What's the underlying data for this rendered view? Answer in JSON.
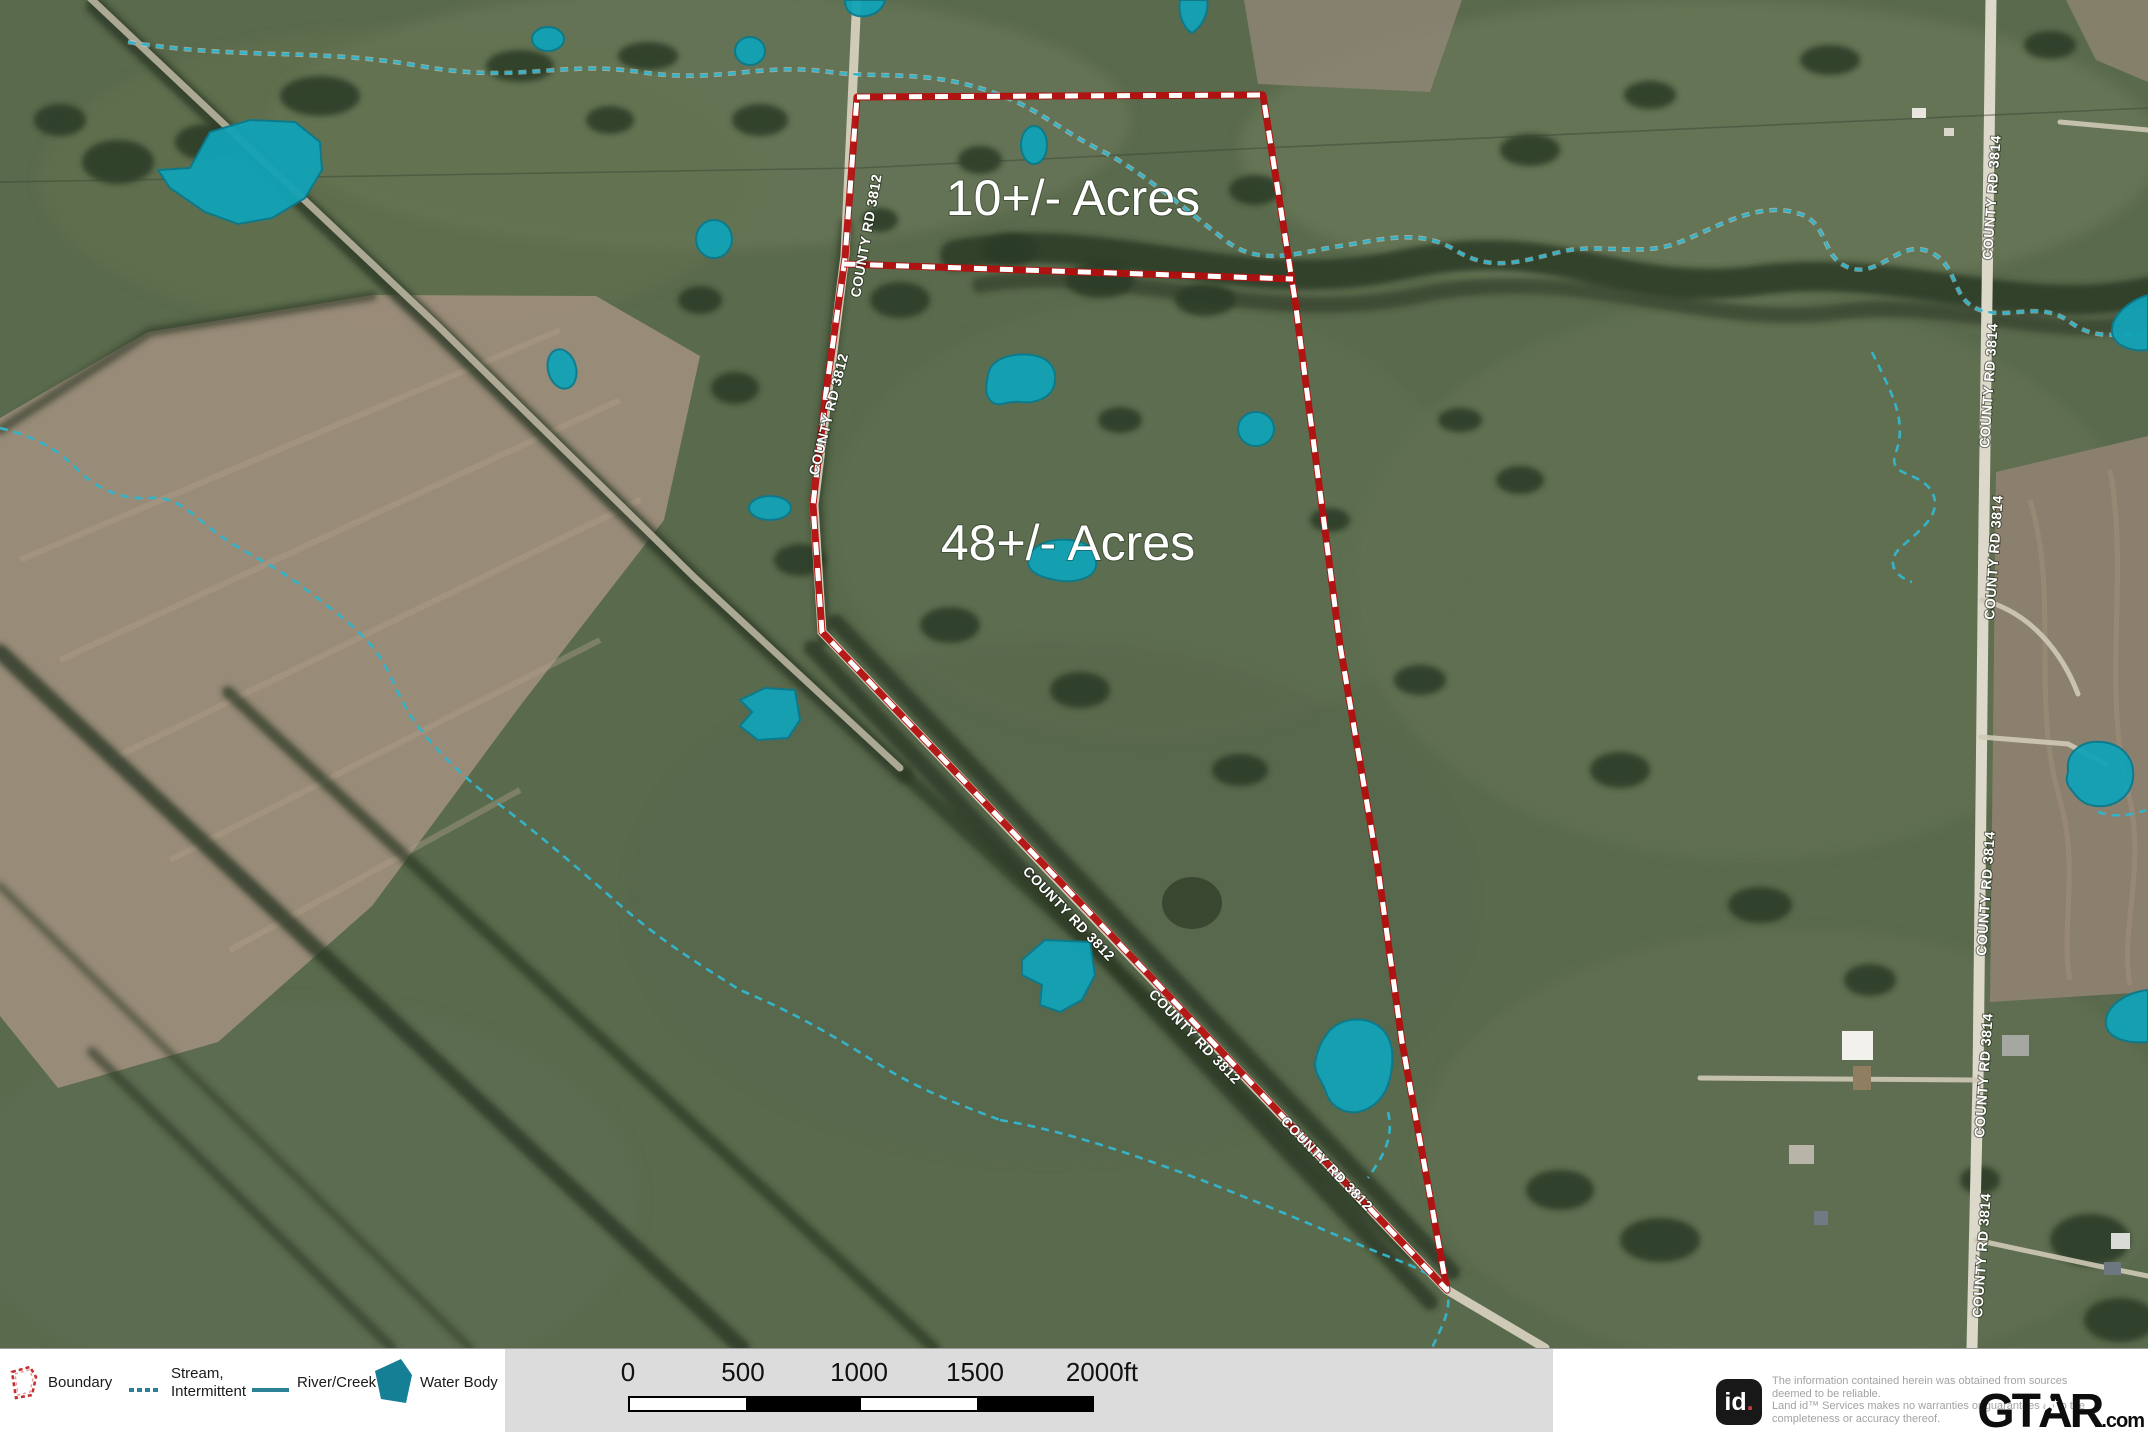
{
  "map": {
    "acre_labels": {
      "parcel_10": "10+/- Acres",
      "parcel_48": "48+/- Acres"
    },
    "roads": {
      "cr3812": "COUNTY RD 3812",
      "cr3814": "COUNTY RD 3814"
    }
  },
  "legend": {
    "boundary": "Boundary",
    "stream_line1": "Stream,",
    "stream_line2": "Intermittent",
    "river": "River/Creek",
    "water_body": "Water Body"
  },
  "scale": {
    "ticks": [
      "0",
      "500",
      "1000",
      "1500",
      "2000ft"
    ]
  },
  "disclaimer": {
    "logo_text": "id",
    "logo_dot": ".",
    "line1": "The information contained herein was obtained from sources",
    "line2": "deemed to be reliable.",
    "line3": "Land id™ Services makes no warranties or guarantees as to the",
    "line4": "completeness or accuracy thereof."
  },
  "branding": {
    "prefix": "GT",
    "a": "A",
    "suffix": "R",
    "tld": ".com",
    "star": "★"
  },
  "colors": {
    "boundary_red": "#b30f0f",
    "water_teal": "#12a3b6",
    "stream_teal": "#35b3c8",
    "field_green": "#5a6a4c",
    "field_brown": "#9b8d7a",
    "scale_bg": "#dcdcdc"
  }
}
